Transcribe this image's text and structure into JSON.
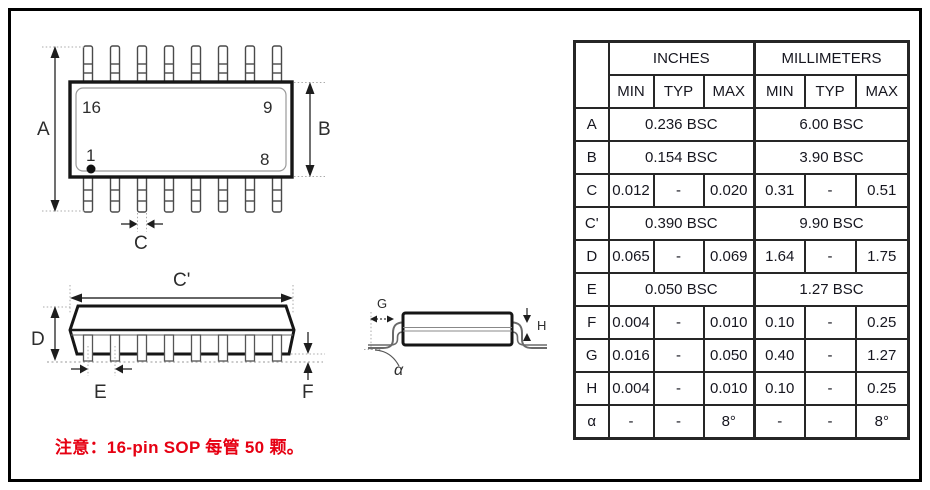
{
  "note": "注意：16-pin SOP 每管 50 颗。",
  "colors": {
    "note_red": "#e60012",
    "ink": "#1b1b24"
  },
  "diagram": {
    "top_view": {
      "pin_labels": [
        "16",
        "9",
        "1",
        "8"
      ],
      "dims": {
        "a": "A",
        "b": "B",
        "c": "C"
      }
    },
    "side_view": {
      "dims": {
        "c_prime": "C'",
        "d": "D",
        "e": "E",
        "f": "F"
      }
    },
    "end_view": {
      "dims": {
        "g": "G",
        "h": "H",
        "alpha": "α"
      }
    }
  },
  "table": {
    "col_groups": [
      "INCHES",
      "MILLIMETERS"
    ],
    "sub_headers": [
      "MIN",
      "TYP",
      "MAX",
      "MIN",
      "TYP",
      "MAX"
    ],
    "rows": [
      {
        "dim": "A",
        "in": [
          "0.236 BSC"
        ],
        "mm": [
          "6.00 BSC"
        ]
      },
      {
        "dim": "B",
        "in": [
          "0.154 BSC"
        ],
        "mm": [
          "3.90 BSC"
        ]
      },
      {
        "dim": "C",
        "in": [
          "0.012",
          "-",
          "0.020"
        ],
        "mm": [
          "0.31",
          "-",
          "0.51"
        ]
      },
      {
        "dim": "C'",
        "in": [
          "0.390 BSC"
        ],
        "mm": [
          "9.90 BSC"
        ]
      },
      {
        "dim": "D",
        "in": [
          "0.065",
          "-",
          "0.069"
        ],
        "mm": [
          "1.64",
          "-",
          "1.75"
        ]
      },
      {
        "dim": "E",
        "in": [
          "0.050 BSC"
        ],
        "mm": [
          "1.27 BSC"
        ]
      },
      {
        "dim": "F",
        "in": [
          "0.004",
          "-",
          "0.010"
        ],
        "mm": [
          "0.10",
          "-",
          "0.25"
        ]
      },
      {
        "dim": "G",
        "in": [
          "0.016",
          "-",
          "0.050"
        ],
        "mm": [
          "0.40",
          "-",
          "1.27"
        ]
      },
      {
        "dim": "H",
        "in": [
          "0.004",
          "-",
          "0.010"
        ],
        "mm": [
          "0.10",
          "-",
          "0.25"
        ]
      },
      {
        "dim": "α",
        "in": [
          "-",
          "-",
          "8°"
        ],
        "mm": [
          "-",
          "-",
          "8°"
        ]
      }
    ]
  }
}
